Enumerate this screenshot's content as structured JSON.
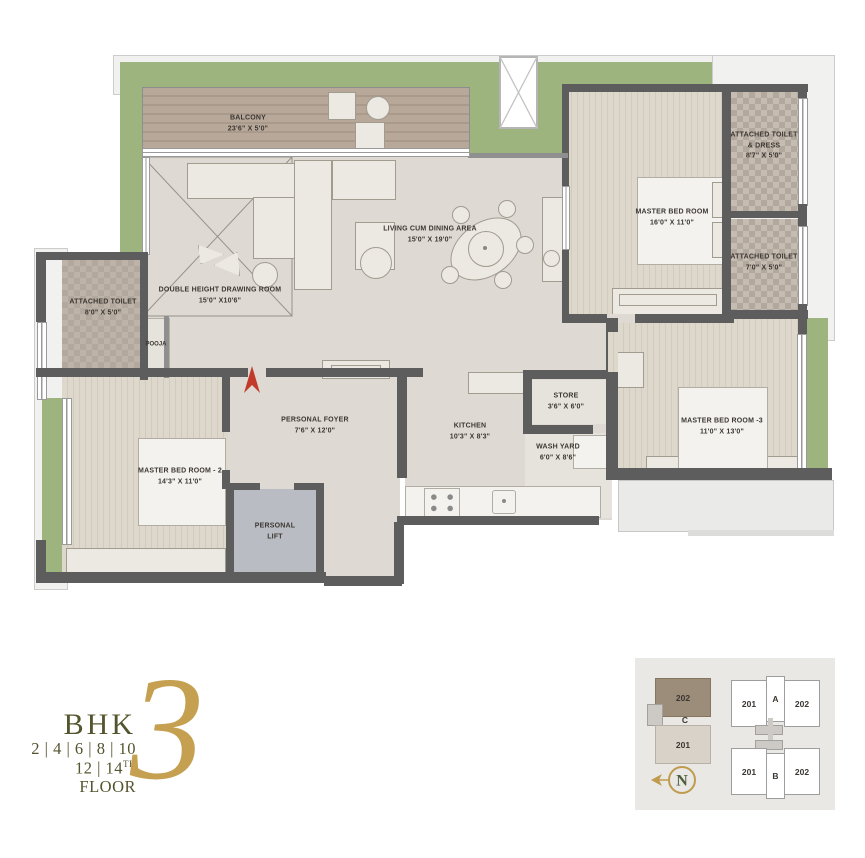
{
  "rooms": {
    "balcony": {
      "name": "BALCONY",
      "dims": "23'6\" X 5'0\""
    },
    "drawing_room": {
      "name": "DOUBLE HEIGHT DRAWING ROOM",
      "dims": "15'0\" X10'6\""
    },
    "living_dining": {
      "name": "LIVING CUM DINING AREA",
      "dims": "15'0\" X 19'0\""
    },
    "master_bedroom_1": {
      "name": "MASTER BED ROOM",
      "dims": "16'0\" X 11'0\""
    },
    "attached_toilet_dress": {
      "name": "ATTACHED TOILET & DRESS",
      "dims": "8'7\" X 5'0\""
    },
    "attached_toilet_master": {
      "name": "ATTACHED TOILET",
      "dims": "7'0\" X 5'0\""
    },
    "attached_toilet_left": {
      "name": "ATTACHED TOILET",
      "dims": "8'0\" X 5'0\""
    },
    "pooja": {
      "name": "POOJA",
      "dims": ""
    },
    "personal_foyer": {
      "name": "PERSONAL FOYER",
      "dims": "7'6\" X 12'0\""
    },
    "personal_lift": {
      "name": "PERSONAL LIFT",
      "dims": ""
    },
    "kitchen": {
      "name": "KITCHEN",
      "dims": "10'3\" X 8'3\""
    },
    "store": {
      "name": "STORE",
      "dims": "3'6\" X 6'0\""
    },
    "wash_yard": {
      "name": "WASH YARD",
      "dims": "6'0\" X 8'6\""
    },
    "master_bedroom_2": {
      "name": "MASTER BED ROOM - 2",
      "dims": "14'3\" X 11'0\""
    },
    "master_bedroom_3": {
      "name": "MASTER BED ROOM -3",
      "dims": "11'0\" X 13'0\""
    }
  },
  "logo": {
    "bhk": "BHK",
    "number": "3",
    "floors_line1": "2 | 4 | 6 | 8 | 10",
    "floors_line2_prefix": "12 | 14",
    "floors_line2_sup": "TH",
    "floors_line2_suffix": " FLOOR"
  },
  "keyplan": {
    "tower_c": {
      "unit_top": "202",
      "tower": "C",
      "unit_bottom": "201"
    },
    "tower_a": {
      "unit_left": "201",
      "tower": "A",
      "unit_right": "202"
    },
    "tower_b": {
      "unit_left": "201",
      "tower": "B",
      "unit_right": "202"
    },
    "north_label": "N"
  },
  "colors": {
    "landscape_green": "#9eb47f",
    "wall_gray": "#5d5d5d",
    "logo_olive": "#54552e",
    "accent_gold": "#c5a050",
    "highlight_unit_brown": "#9c8d7b",
    "entry_arrow_red": "#c23b2a"
  }
}
